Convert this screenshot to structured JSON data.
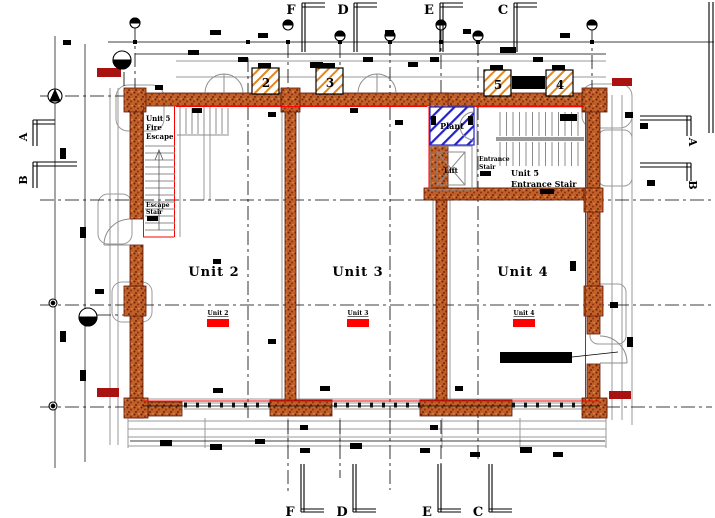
{
  "grid": {
    "top_letters": [
      "F",
      "D",
      "E",
      "C"
    ],
    "bottom_letters": [
      "F",
      "D",
      "E",
      "C"
    ],
    "left_sections": [
      "A",
      "B"
    ],
    "right_sections": [
      "A",
      "B"
    ]
  },
  "shaft_numbers": [
    "2",
    "3",
    "5",
    "4"
  ],
  "units": {
    "unit2": {
      "label": "Unit 2",
      "tag": "Unit 2"
    },
    "unit3": {
      "label": "Unit 3",
      "tag": "Unit 3"
    },
    "unit4": {
      "label": "Unit 4",
      "tag": "Unit 4"
    }
  },
  "rooms": {
    "fire_escape": {
      "line1": "Unit 5",
      "line2": "Fire",
      "line3": "Escape"
    },
    "escape_stair": {
      "line1": "Escape",
      "line2": "Stair"
    },
    "plant": {
      "label": "Plant"
    },
    "lift": {
      "label": "Lift"
    },
    "entrance_stair": {
      "line1": "Entrance",
      "line2": "Stair"
    },
    "unit5_entrance": {
      "line1": "Unit 5",
      "line2": "Entrance Stair"
    }
  },
  "colors": {
    "wall_fill": "#c06028",
    "wall_edge": "#5a1505",
    "red_line": "#ff0000",
    "marker_red": "#aa1111",
    "plant_blue": "#2323cc",
    "shaft_hatch_orange": "#e2861e",
    "secondary_grey": "#9a9a9a"
  }
}
